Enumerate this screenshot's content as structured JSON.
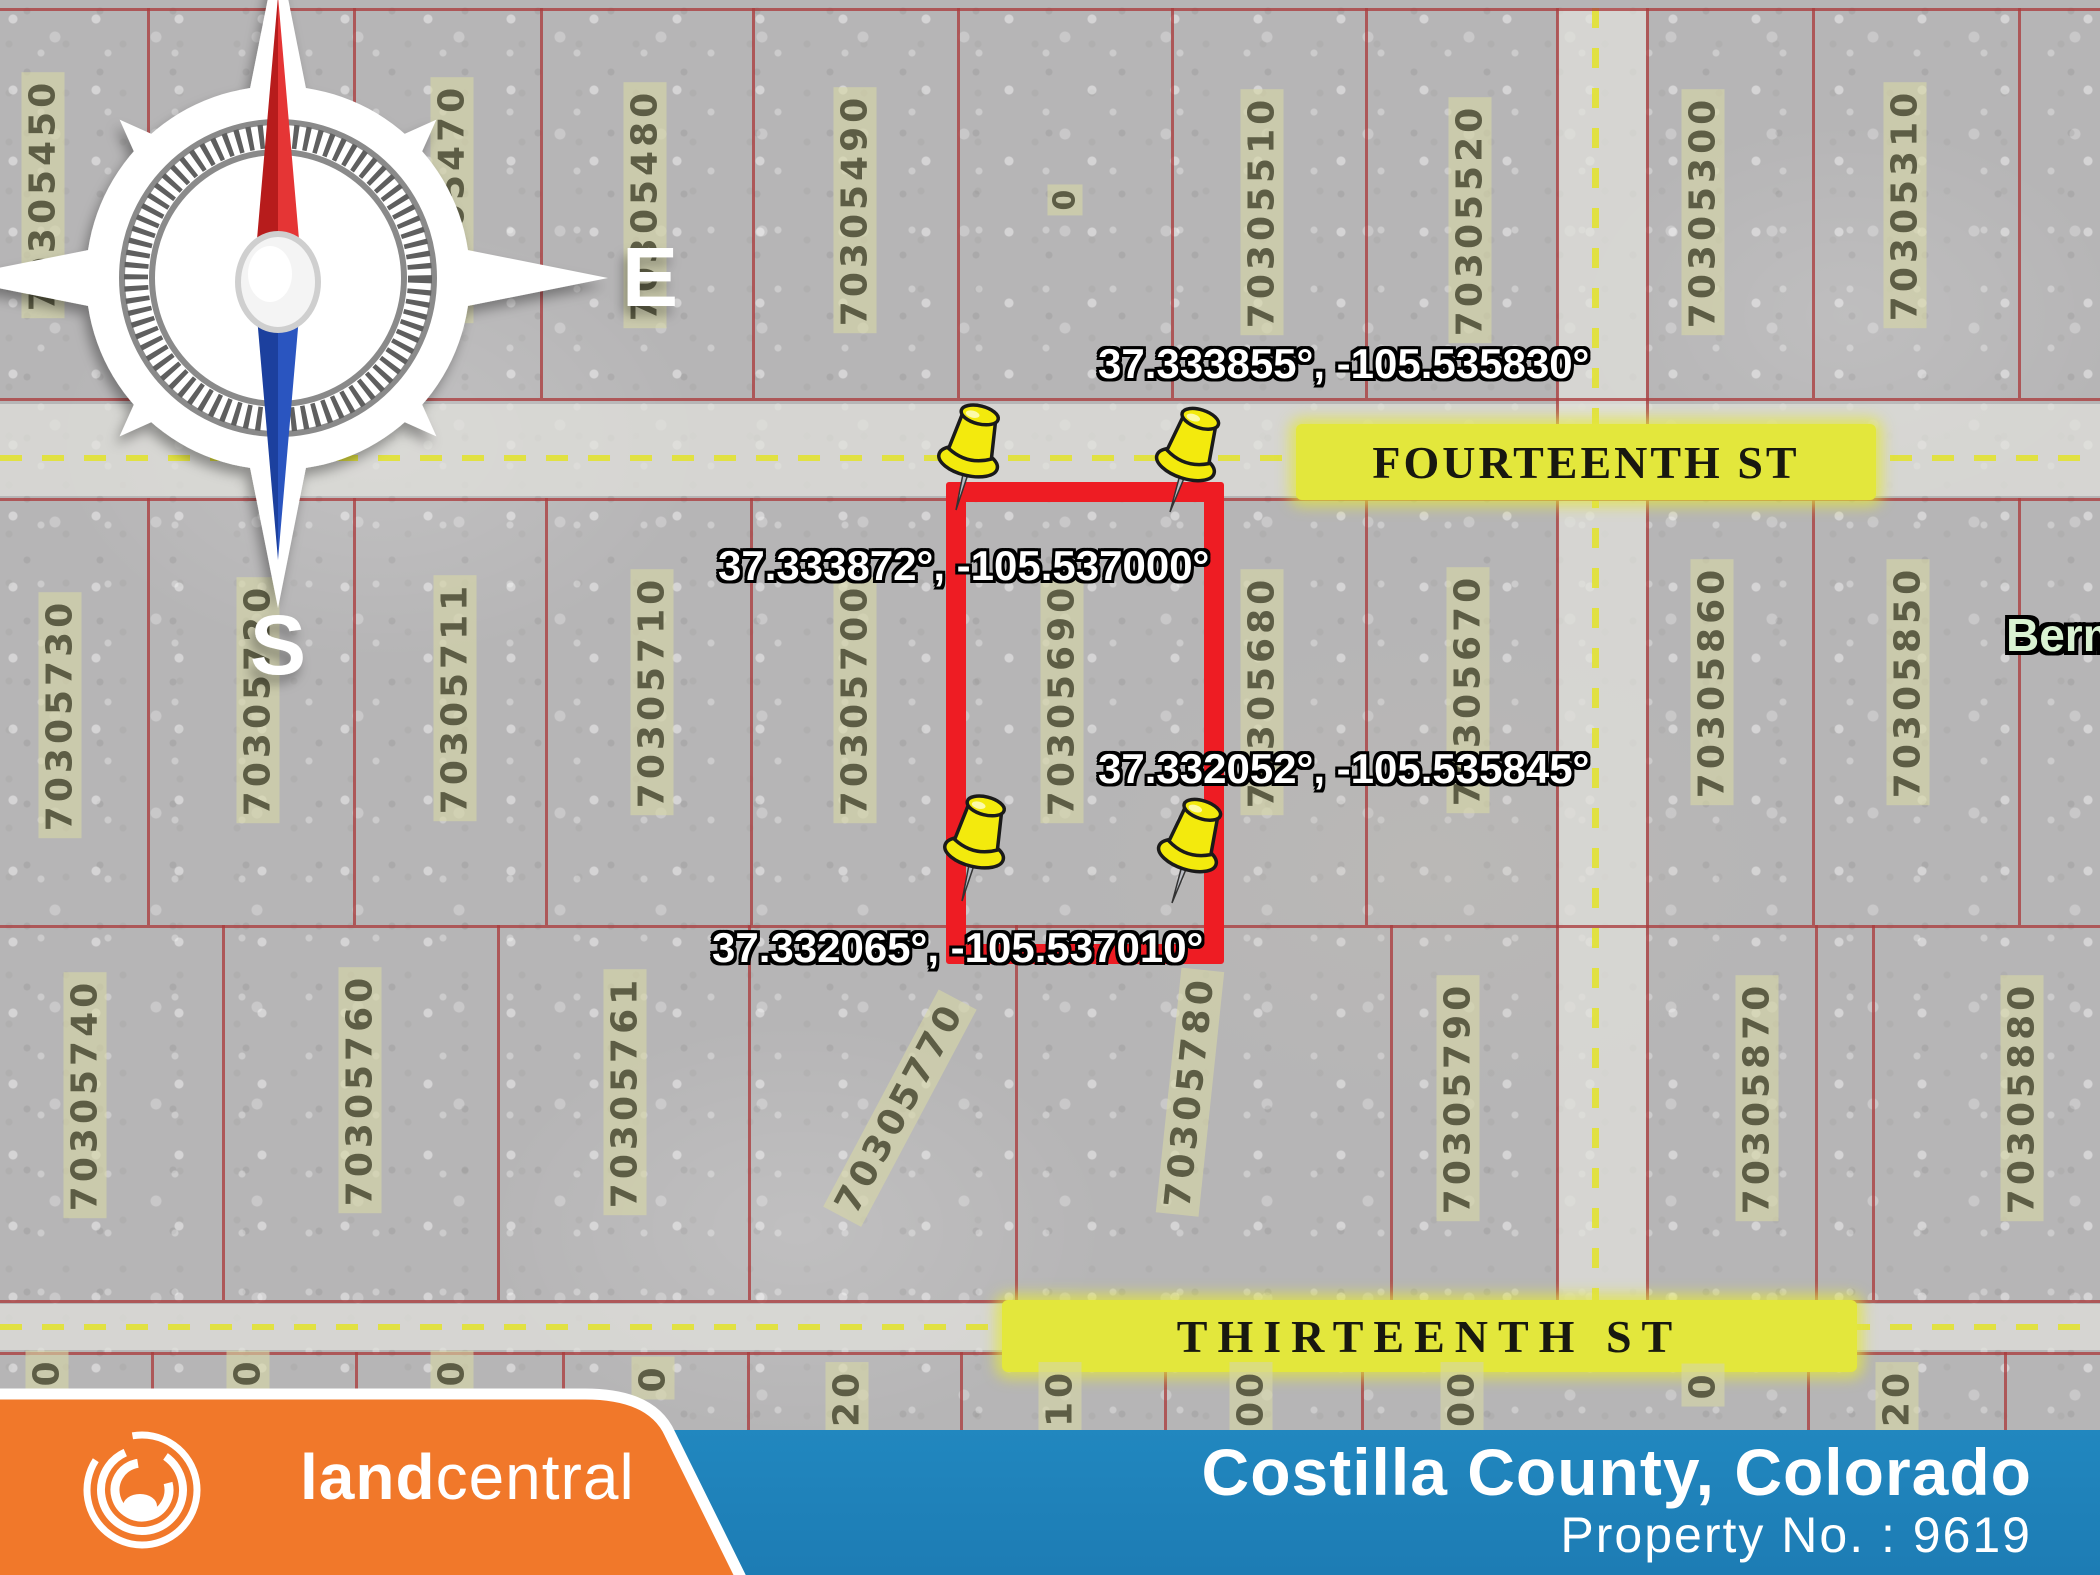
{
  "map": {
    "compass": {
      "north": "N",
      "south": "S",
      "east": "E",
      "west": "W"
    },
    "streets": {
      "fourteenth": "FOURTEENTH ST",
      "thirteenth": "THIRTEENTH ST"
    },
    "edge_label": "Berm",
    "parcels_top": [
      "70305450",
      "70305460",
      "70305470",
      "70305480",
      "70305490",
      "0",
      "70305510",
      "70305520",
      "70305300",
      "70305310"
    ],
    "parcels_middle": [
      "70305730",
      "70305720",
      "70305711",
      "70305710",
      "70305700",
      "70305690",
      "70305680",
      "70305670",
      "70305860",
      "70305850"
    ],
    "parcels_bottom": [
      "70305740",
      "70305760",
      "70305761",
      "70305770",
      "70305780",
      "70305790",
      "70305870",
      "70305880"
    ],
    "parcels_cutoff": [
      "0",
      "0",
      "0",
      "0",
      "20",
      "10",
      "00",
      "00",
      "0",
      "20"
    ],
    "highlight_parcel": "70305690",
    "coordinates": {
      "top_left": "37.333872°, -105.537000°",
      "top_right": "37.333855°, -105.535830°",
      "bottom_left": "37.332065°, -105.537010°",
      "bottom_right": "37.332052°, -105.535845°"
    }
  },
  "footer": {
    "brand_land": "land",
    "brand_central": "central",
    "county": "Costilla County, Colorado",
    "property_no": "Property No. : 9619"
  },
  "colors": {
    "highlight_red": "#ee1c23",
    "pin_yellow": "#f3ea0d",
    "street_highlight": "#e3e73c",
    "brand_orange": "#f1782a",
    "brand_blue": "#1e80ba",
    "grid_red": "#aa3c3e",
    "parcel_text": "#5d5d45"
  }
}
